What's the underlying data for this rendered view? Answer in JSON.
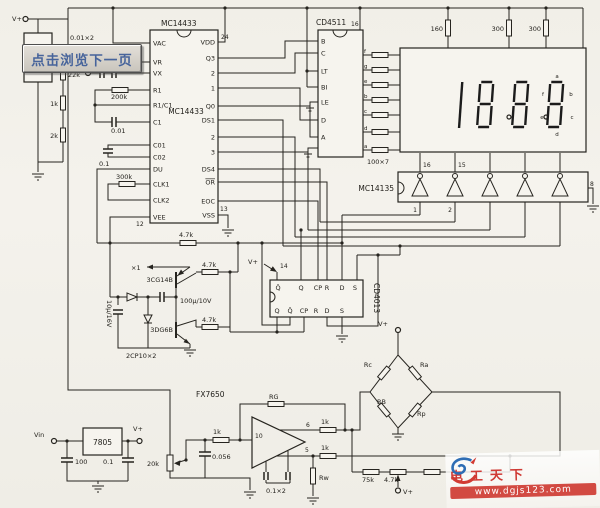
{
  "power": {
    "v_top": "V+",
    "vin": "Vin",
    "v_out": "V+",
    "v_4013": "V+",
    "v_bridge": "V+",
    "v_pot": "V+"
  },
  "input": {
    "cap_label": "0.01×2"
  },
  "divider": {
    "r22k": "22k",
    "r1k": "1k",
    "r2k": "2k"
  },
  "mc14433": {
    "title": "MC14433",
    "inner": "MC14433",
    "left_pins": [
      "VAC",
      "VR",
      "VX",
      "R1",
      "R1/C1",
      "C1",
      "C01",
      "C02",
      "DU",
      "CLK1",
      "CLK2",
      "VEE"
    ],
    "right_pins": [
      "VDD",
      "Q3",
      "2",
      "1",
      "Q0",
      "DS1",
      "2",
      "3",
      "DS4",
      "OR",
      "EOC",
      "VSS"
    ],
    "num24": "24",
    "num12": "12",
    "num13": "13",
    "r200k": "200k",
    "c001": "0.01",
    "c01": "0.1",
    "r300k": "300k",
    "r47k": "4.7k"
  },
  "cd4511": {
    "title": "CD4511",
    "left_pins": [
      "B",
      "C",
      "LT",
      "BI",
      "LE",
      "D",
      "A"
    ],
    "seg_pins": [
      "f",
      "g",
      "e",
      "b",
      "c",
      "d",
      "a"
    ],
    "num16": "16",
    "array_label": "100×7"
  },
  "display": {
    "r160": "160",
    "r300a": "300",
    "r300b": "300",
    "value": "1888",
    "segs": {
      "a": "a",
      "b": "b",
      "c": "c",
      "d": "d",
      "e": "e",
      "f": "f"
    }
  },
  "driver": {
    "title": "MC14135",
    "num16": "16",
    "num15": "15",
    "num1": "1",
    "num2": "2",
    "num8": "8"
  },
  "cd4013": {
    "title": "CD4013",
    "num14": "14",
    "top_pins": [
      "Q̄",
      "Q",
      "CP",
      "R",
      "D",
      "S"
    ],
    "bottom_pins": [
      "Q",
      "Q̄",
      "CP",
      "R",
      "D",
      "S"
    ]
  },
  "osc": {
    "x1": "×1",
    "pnp": "3CG14B",
    "npn": "3DG6B",
    "r47k_top": "4.7k",
    "r47k_bot": "4.7k",
    "cap1": "100μ/10V",
    "cap2": "10μ/16V",
    "diodes": "2CP10×2"
  },
  "reg": {
    "title": "7805",
    "c_in": "100",
    "c_out": "0.1"
  },
  "amp": {
    "title": "FX7650",
    "rg": "RG",
    "r_in": "1k",
    "pot": "20k",
    "c_in": "0.056",
    "num10": "10",
    "num6": "6",
    "num5": "5",
    "r_out_a": "1k",
    "r_out_b": "1k",
    "c_guard": "0.1×2",
    "rw": "Rw",
    "r75k": "75k",
    "pot47k": "4.7k"
  },
  "bridge": {
    "rc": "Rc",
    "ra": "Ra",
    "rb": "RB",
    "rp": "Rp"
  },
  "button": {
    "label": "点击浏览下一页"
  },
  "watermark": {
    "title": "电工天下",
    "url": "www.dgjs123.com"
  }
}
